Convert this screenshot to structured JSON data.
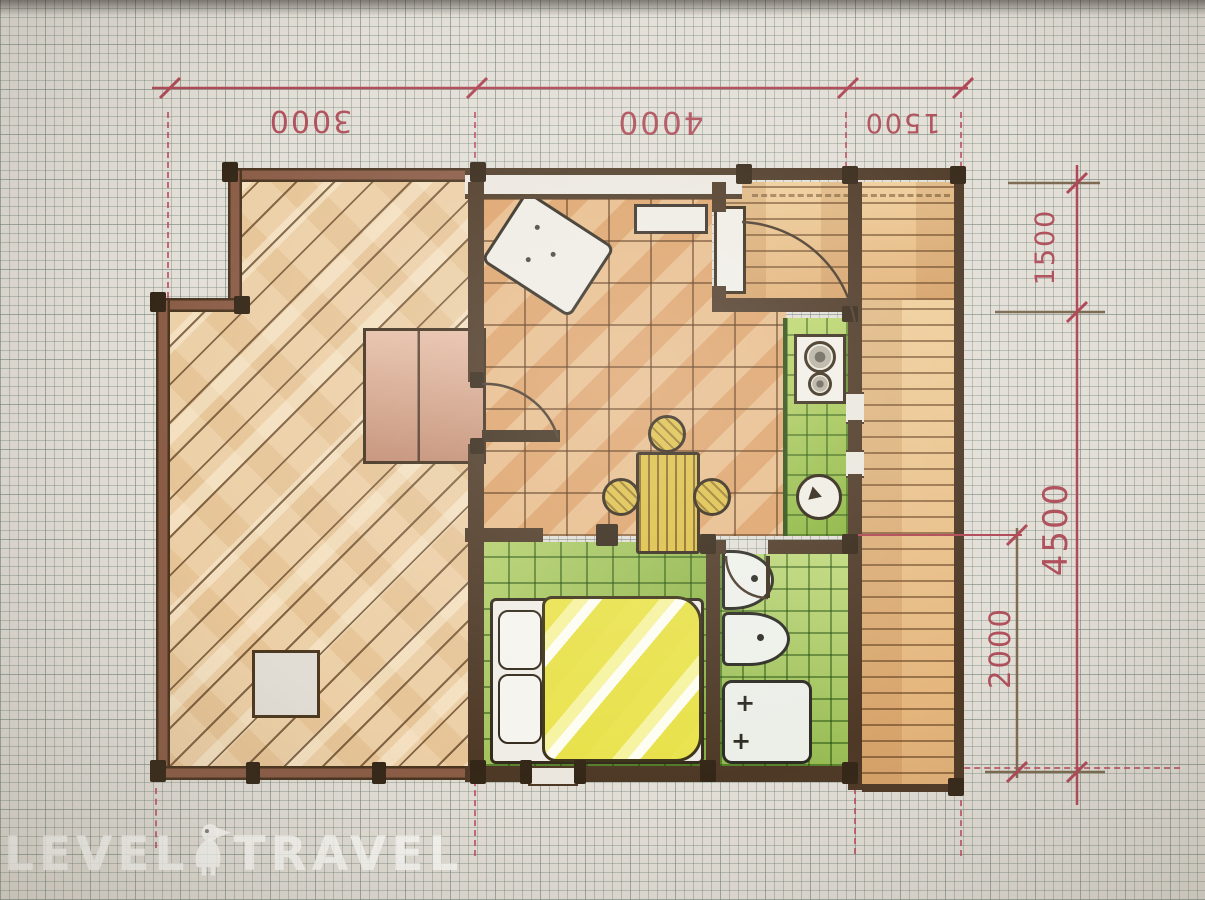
{
  "watermark": {
    "left_text": "LEVEL",
    "right_text": "TRAVEL",
    "icon": "bird-logo-icon"
  },
  "dimensions": {
    "top": [
      {
        "label": "3000"
      },
      {
        "label": "4000"
      },
      {
        "label": "1500"
      }
    ],
    "right": [
      {
        "label": "1500"
      },
      {
        "label": "4500"
      },
      {
        "label": "2000"
      }
    ]
  },
  "palette": {
    "paper": "#e3dfd7",
    "grid_line": "#aab4ac",
    "dimension_red": "#b04856",
    "wall_brown": "#4e3926",
    "terrace_tan": "#eccfa6",
    "floor_orange": "#e2ae7a",
    "deck_orange": "#e9c28c",
    "area_green": "#a2c64e",
    "bed_yellow": "#ece24e"
  },
  "fixtures": [
    "sofa-bed",
    "wardrobe",
    "window-bench",
    "dining-table",
    "stool",
    "stove",
    "kitchen-sink",
    "double-bed",
    "pillow",
    "washbasin",
    "toilet",
    "shower-tray",
    "door-swing",
    "terrace-hatch"
  ]
}
